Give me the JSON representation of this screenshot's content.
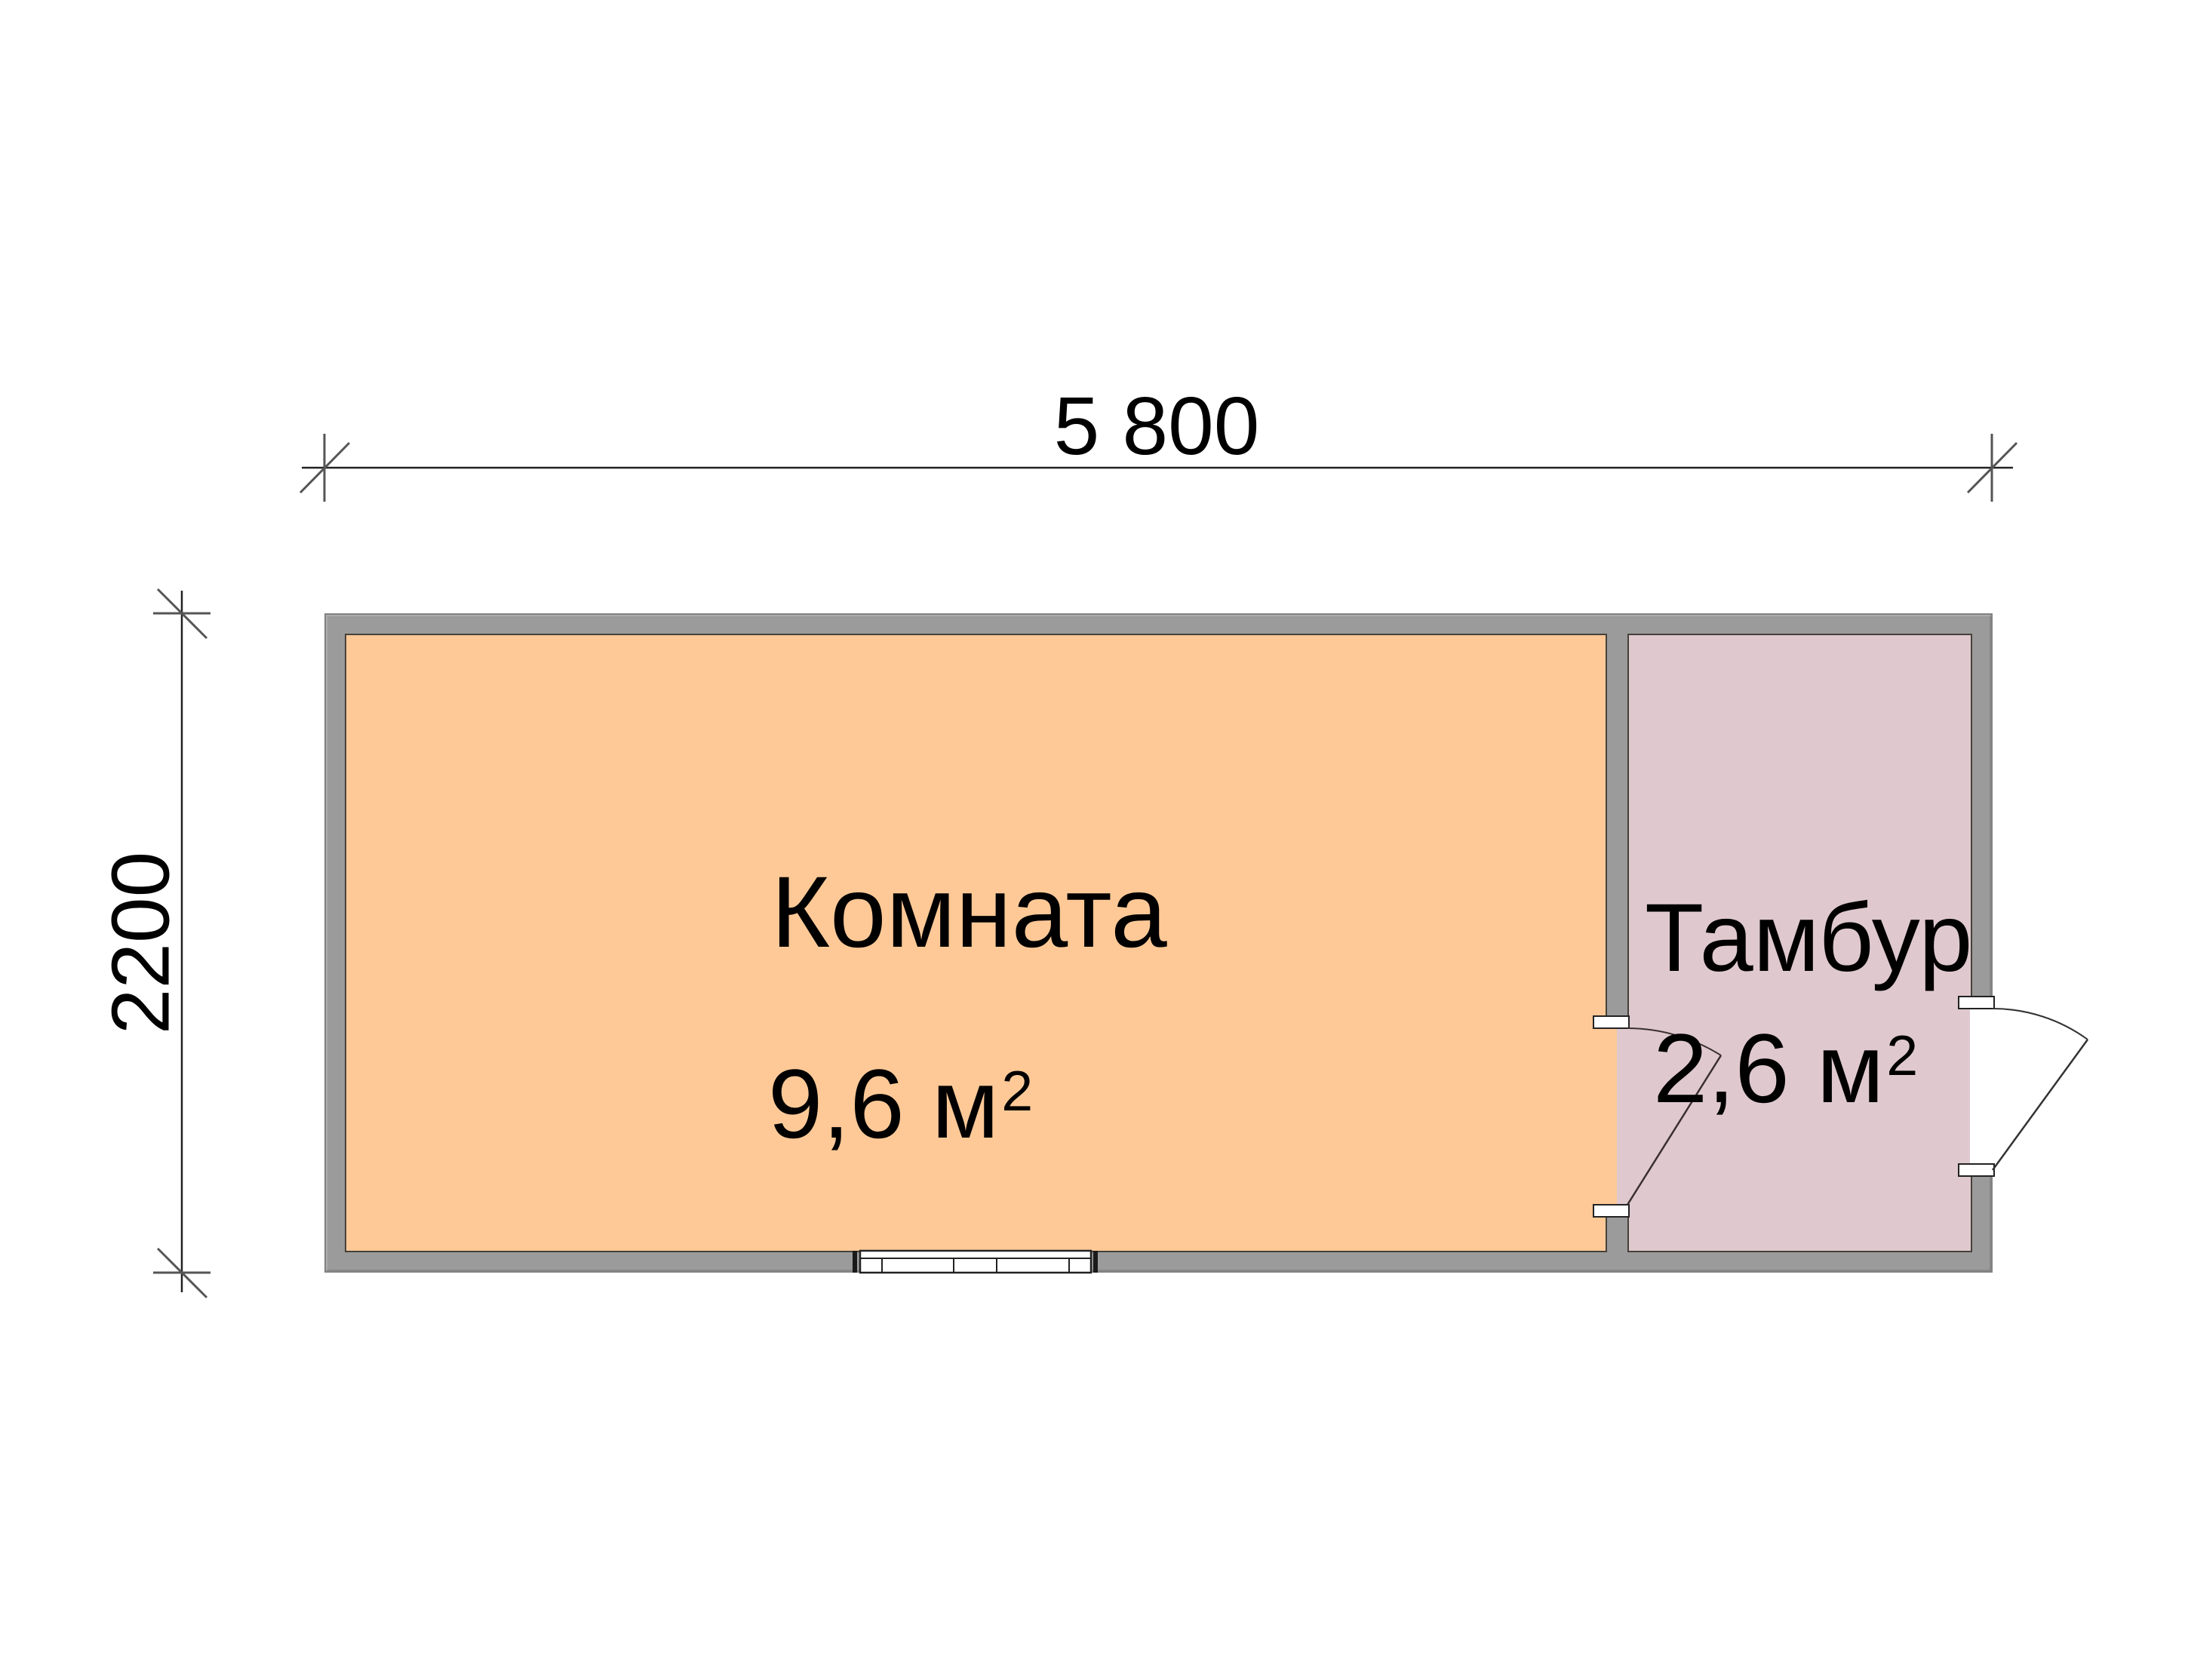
{
  "plan": {
    "dimensions": {
      "width_label": "5 800",
      "height_label": "2200"
    },
    "rooms": [
      {
        "name": "Комната",
        "area": "9,6 м",
        "area_sup": "2",
        "fill": "#fec997"
      },
      {
        "name": "Тамбур",
        "area": "2,6 м",
        "area_sup": "2",
        "fill": "#dfc9ce"
      }
    ],
    "colors": {
      "wall": "#9b9b9b",
      "wall_edge": "#45413a",
      "line": "#222222",
      "background": "#ffffff"
    },
    "symbols": {
      "window": "window-symbol",
      "exterior_door": "door-symbol-exterior",
      "interior_door": "door-symbol-interior"
    }
  }
}
